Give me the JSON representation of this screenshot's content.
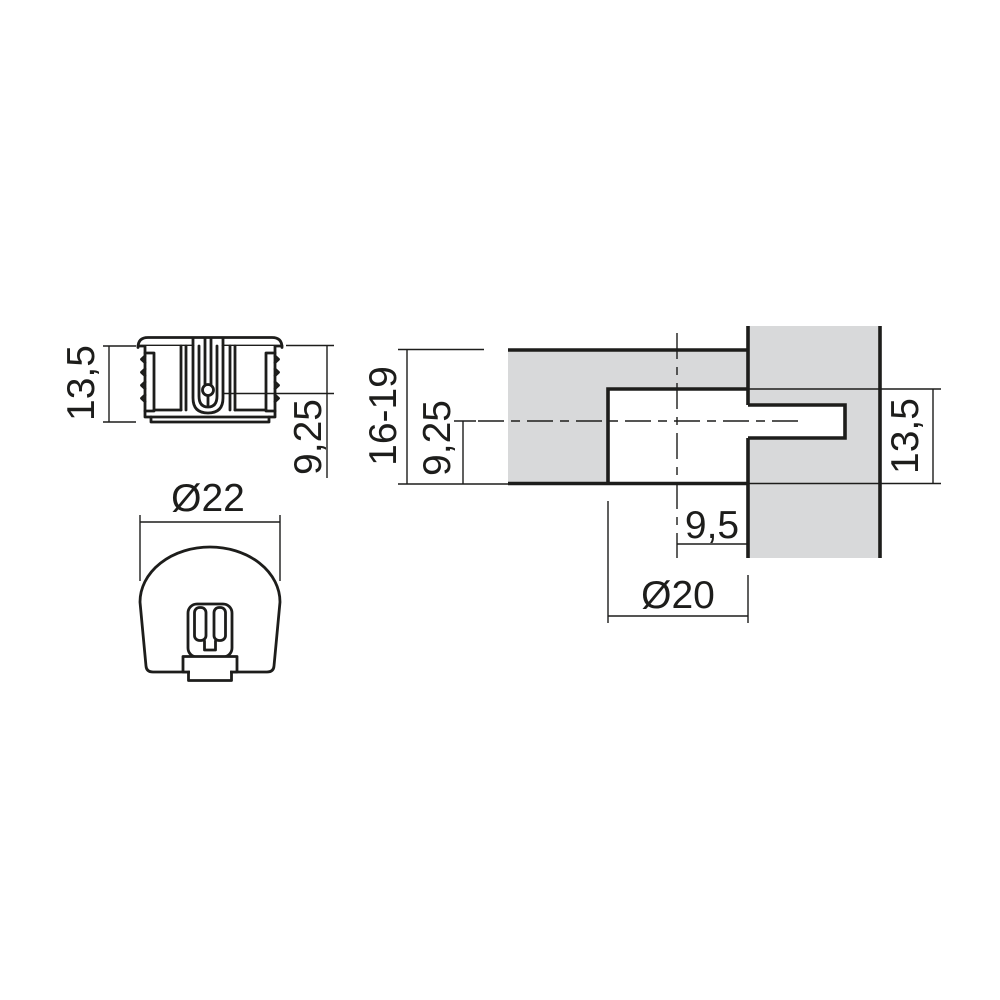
{
  "drawing": {
    "line_color": "#1d1d1b",
    "panel_fill": "#d8d9da",
    "side_view": {
      "height_label": "13,5",
      "axis_label": "9,25"
    },
    "front_view": {
      "diameter_label": "Ø22"
    },
    "section_view": {
      "thickness_label": "16-19",
      "axis_label": "9,25",
      "bore_label": "13,5",
      "edge_label": "9,5",
      "hole_label": "Ø20"
    }
  }
}
